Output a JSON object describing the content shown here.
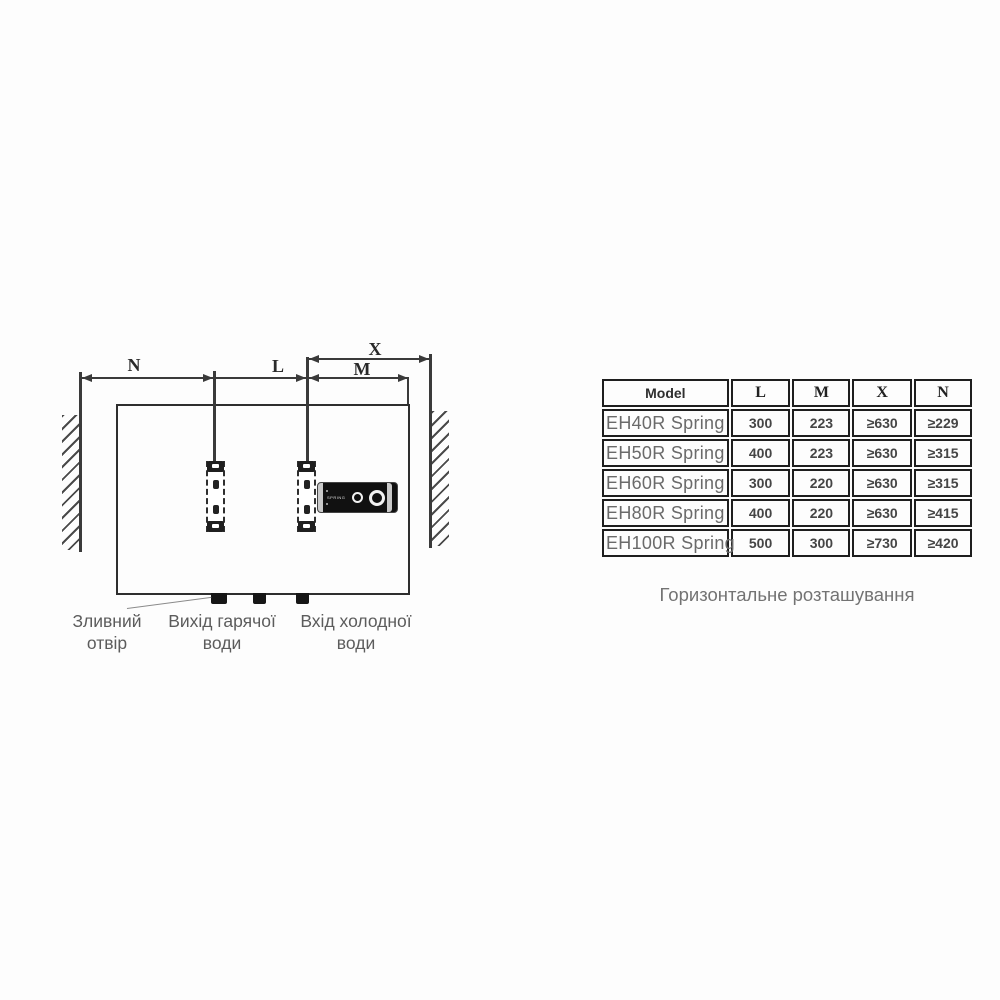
{
  "diagram": {
    "dim_labels": {
      "n": "N",
      "l": "L",
      "m": "M",
      "x": "X"
    },
    "panel_text": "SPRING",
    "connections": [
      {
        "line1": "Зливний",
        "line2": "отвір"
      },
      {
        "line1": "Вихід гарячої",
        "line2": "води"
      },
      {
        "line1": "Вхід холодної",
        "line2": "води"
      }
    ]
  },
  "table": {
    "headers": [
      "Model",
      "L",
      "M",
      "X",
      "N"
    ],
    "rows": [
      [
        "EH40R Spring",
        "300",
        "223",
        "≥630",
        "≥229"
      ],
      [
        "EH50R Spring",
        "400",
        "223",
        "≥630",
        "≥315"
      ],
      [
        "EH60R Spring",
        "300",
        "220",
        "≥630",
        "≥315"
      ],
      [
        "EH80R Spring",
        "400",
        "220",
        "≥630",
        "≥415"
      ],
      [
        "EH100R Spring",
        "500",
        "300",
        "≥730",
        "≥420"
      ]
    ]
  },
  "caption": "Горизонтальне розташування",
  "colors": {
    "line": "#3a3a3a",
    "panel": "#111111",
    "text_gray": "#5c5c5c"
  }
}
